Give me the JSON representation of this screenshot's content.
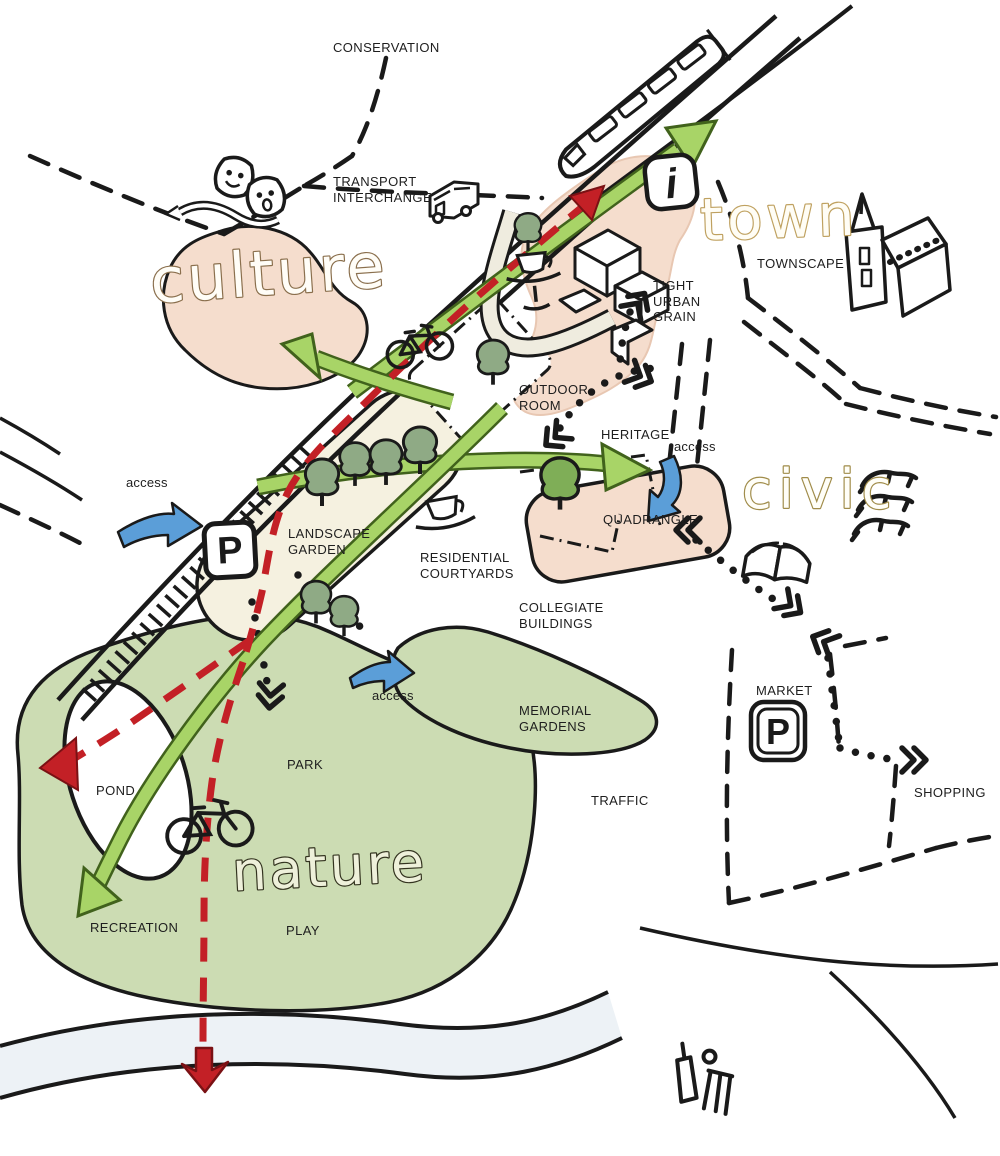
{
  "map_title": "urban design concept diagram",
  "zone_words": {
    "culture": "culture",
    "town": "town",
    "civic": "civic",
    "nature": "nature"
  },
  "labels": {
    "conservation": "CONSERVATION",
    "transport_interchange": "TRANSPORT\nINTERCHANGE",
    "townscape": "TOWNSCAPE",
    "tight_urban_grain": "TIGHT\nURBAN\nGRAIN",
    "outdoor_room": "OUTDOOR\nROOM",
    "heritage": "HERITAGE",
    "access_heritage": "access",
    "quadrangle": "QUADRANGLE",
    "access_west": "access",
    "landscape_garden": "LANDSCAPE\nGARDEN",
    "residential_courtyards": "RESIDENTIAL\nCOURTYARDS",
    "collegiate_buildings": "COLLEGIATE\nBUILDINGS",
    "memorial_gardens": "MEMORIAL\nGARDENS",
    "access_park": "access",
    "market": "MARKET",
    "shopping": "SHOPPING",
    "traffic": "TRAFFIC",
    "pond": "POND",
    "park": "PARK",
    "recreation": "RECREATION",
    "play": "PLAY"
  },
  "icons": {
    "parking_letter": "P",
    "info_letter": "i",
    "theatre_masks": "theatre-masks",
    "bus": "bus",
    "train": "train",
    "church": "church",
    "coffee_cups": "coffee-cup",
    "open_book": "open-book",
    "three_lions_emblem": "three-lions-emblem",
    "bicycles": "bicycle",
    "cricket": "cricket-bat-and-stumps"
  },
  "palette": {
    "zone_peach": "#f5ddcd",
    "courtyard_cream": "#f5f1e0",
    "park_green": "#ccdcb3",
    "tree_green": "#8faa85",
    "bright_tree_green": "#7fae57",
    "route_green": "#a8d467",
    "access_blue": "#5b9ed8",
    "route_red": "#c32026",
    "river_blue": "#edf2f6",
    "ink": "#1a1a1a"
  }
}
